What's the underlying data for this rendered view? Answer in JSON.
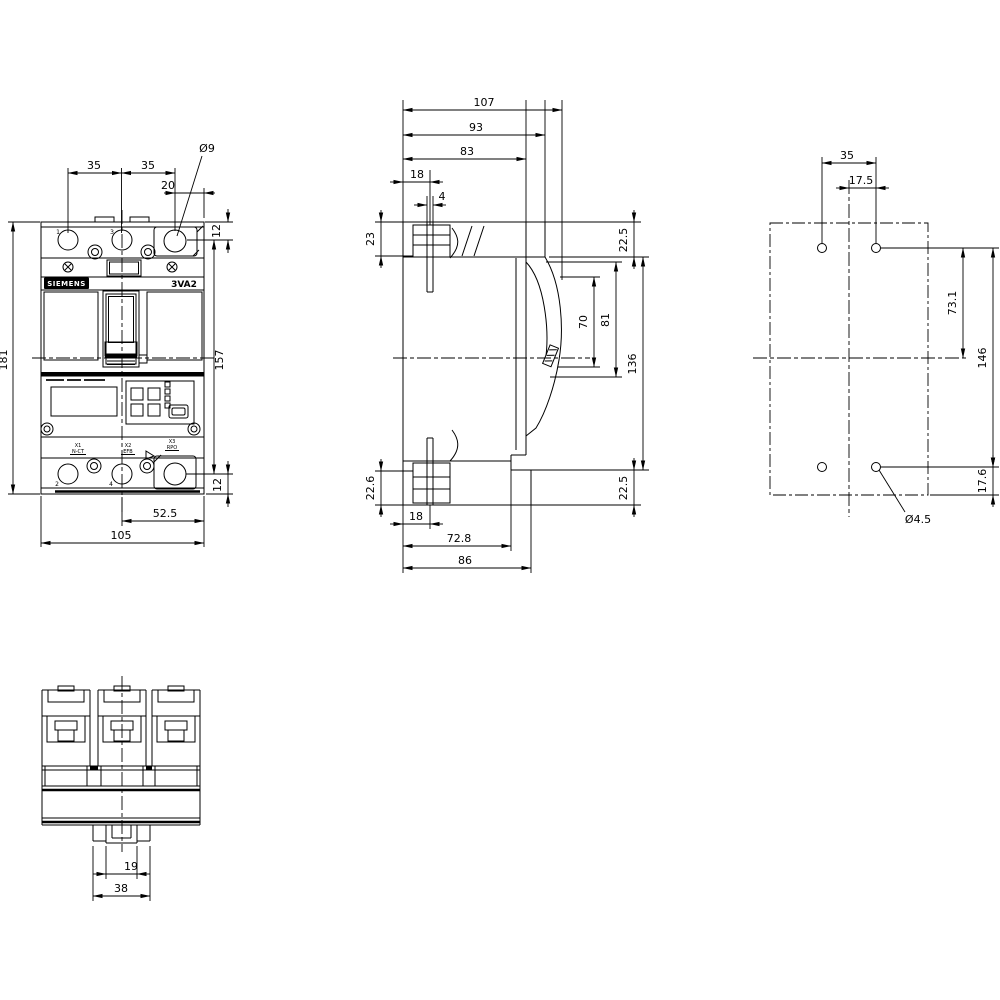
{
  "drawing": {
    "brand": "SIEMENS",
    "model": "3VA2",
    "front_view": {
      "pole_labels": {
        "p1": "1",
        "p3": "3",
        "p2": "2",
        "p4": "4"
      },
      "terminal_labels": {
        "x1": "X1",
        "x1_sub": "N-CT",
        "x2": "X2",
        "x2_sub": "EFB",
        "x3": "X3",
        "x3_sub": "RPO"
      },
      "dims": {
        "pole_pitch_left": "35",
        "pole_pitch_right": "35",
        "hole_offset_top": "20",
        "hole_dia_top": "Ø9",
        "hole_center_top": "12",
        "overall_height": "181",
        "hole_pitch_height": "157",
        "hole_center_bottom": "12",
        "half_width": "52.5",
        "overall_width": "105"
      }
    },
    "side_view": {
      "dims": {
        "overall_depth": "107",
        "depth_93": "93",
        "depth_83": "83",
        "din_slot_offset_top": "18",
        "din_slot_width": "4",
        "clip_height_top": "23",
        "clip_height_bottom": "22.6",
        "step_top": "22.5",
        "escutcheon_height": "70",
        "opening_height": "81",
        "body_height": "136",
        "step_bottom": "22.5",
        "din_slot_offset_bottom": "18",
        "depth_72_8": "72.8",
        "depth_86": "86"
      }
    },
    "mounting_view": {
      "dims": {
        "hole_pitch_width": "35",
        "hole_offset_center": "17.5",
        "hole_to_center": "73.1",
        "hole_pitch_height": "146",
        "hole_offset_bottom": "17.6",
        "hole_dia": "Ø4.5"
      }
    },
    "bottom_view": {
      "dims": {
        "tab_width": "19",
        "bracket_width": "38"
      }
    }
  }
}
